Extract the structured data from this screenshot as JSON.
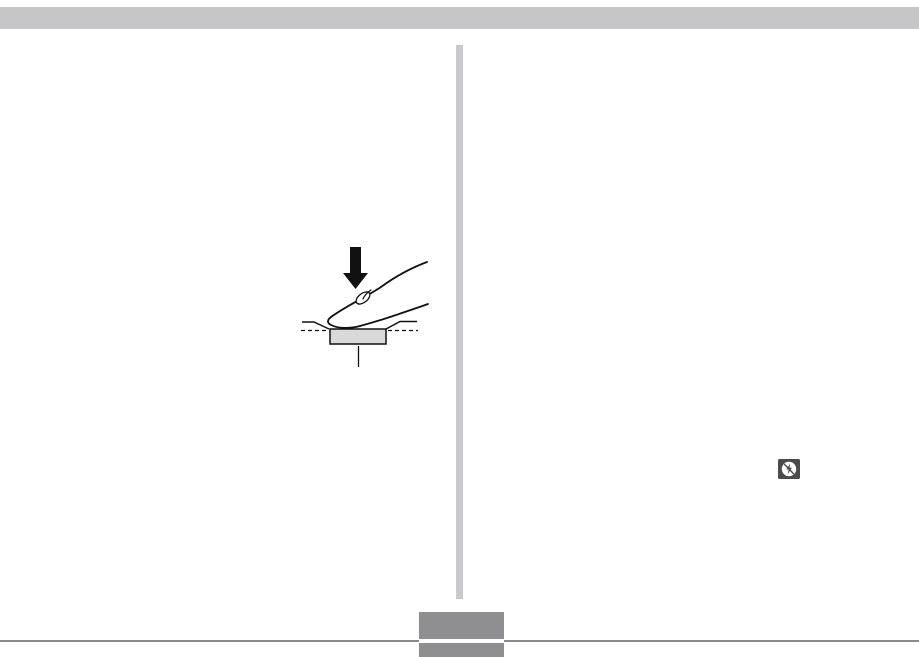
{
  "page": {
    "type": "manual-page-graphics-only",
    "background_color": "#ffffff",
    "top_bar_color": "#c6c6c8",
    "column_divider_color": "#c9c9cb",
    "footer_rule_color": "#8a8a8c",
    "page_number_box_color": "#8f8f91",
    "visible_text": ""
  },
  "illustration": {
    "name": "finger-pressing-shutter-button",
    "down_arrow_color": "#111111",
    "outline_color": "#111111",
    "button_fill_color": "#d9d9d9",
    "nail_fill_color": "#ffffff"
  },
  "icons": [
    {
      "name": "flash-off-icon",
      "background": "#4b4b4b",
      "circle_fill": "#ffffff",
      "glyph_color": "#4b4b4b"
    }
  ]
}
